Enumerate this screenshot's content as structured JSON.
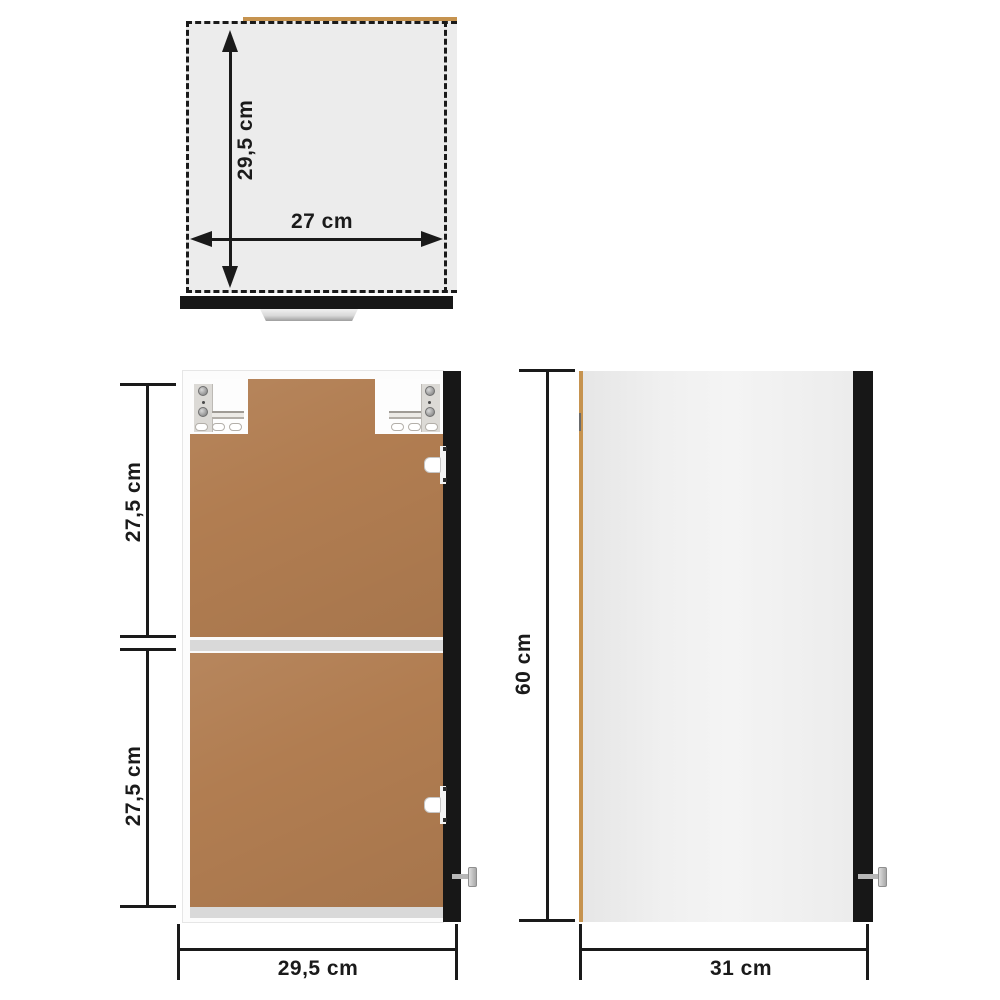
{
  "diagram_title": "Wall cabinet dimension diagram (top, front and side views)",
  "colors": {
    "ink": "#1a1a1a",
    "panel_gray_fill": "#ececec",
    "wood_edge": "#c6934f",
    "door_black": "#171717",
    "hardboard_brown": "#b17d51",
    "shelf_gray": "#d9d9d9",
    "body_white": "#fcfcfc",
    "hardware_gray": "#b8b8b8",
    "bracket_gray": "#dcdad6"
  },
  "top_view": {
    "depth_label": "29,5 cm",
    "width_label": "27 cm"
  },
  "front_view": {
    "upper_section_label": "27,5 cm",
    "lower_section_label": "27,5 cm",
    "width_label": "29,5 cm"
  },
  "side_view": {
    "height_label": "60 cm",
    "depth_label": "31 cm"
  },
  "measurements": [
    {
      "view": "top",
      "label": "29,5 cm",
      "value_cm": 29.5,
      "orientation": "vertical",
      "style": "double-arrow"
    },
    {
      "view": "top",
      "label": "27 cm",
      "value_cm": 27,
      "orientation": "horizontal",
      "style": "double-arrow"
    },
    {
      "view": "front",
      "label": "27,5 cm",
      "value_cm": 27.5,
      "orientation": "vertical",
      "style": "tick-line"
    },
    {
      "view": "front",
      "label": "27,5 cm",
      "value_cm": 27.5,
      "orientation": "vertical",
      "style": "tick-line"
    },
    {
      "view": "front",
      "label": "29,5 cm",
      "value_cm": 29.5,
      "orientation": "horizontal",
      "style": "tick-line"
    },
    {
      "view": "side",
      "label": "60 cm",
      "value_cm": 60,
      "orientation": "vertical",
      "style": "tick-line"
    },
    {
      "view": "side",
      "label": "31 cm",
      "value_cm": 31,
      "orientation": "horizontal",
      "style": "tick-line"
    }
  ]
}
